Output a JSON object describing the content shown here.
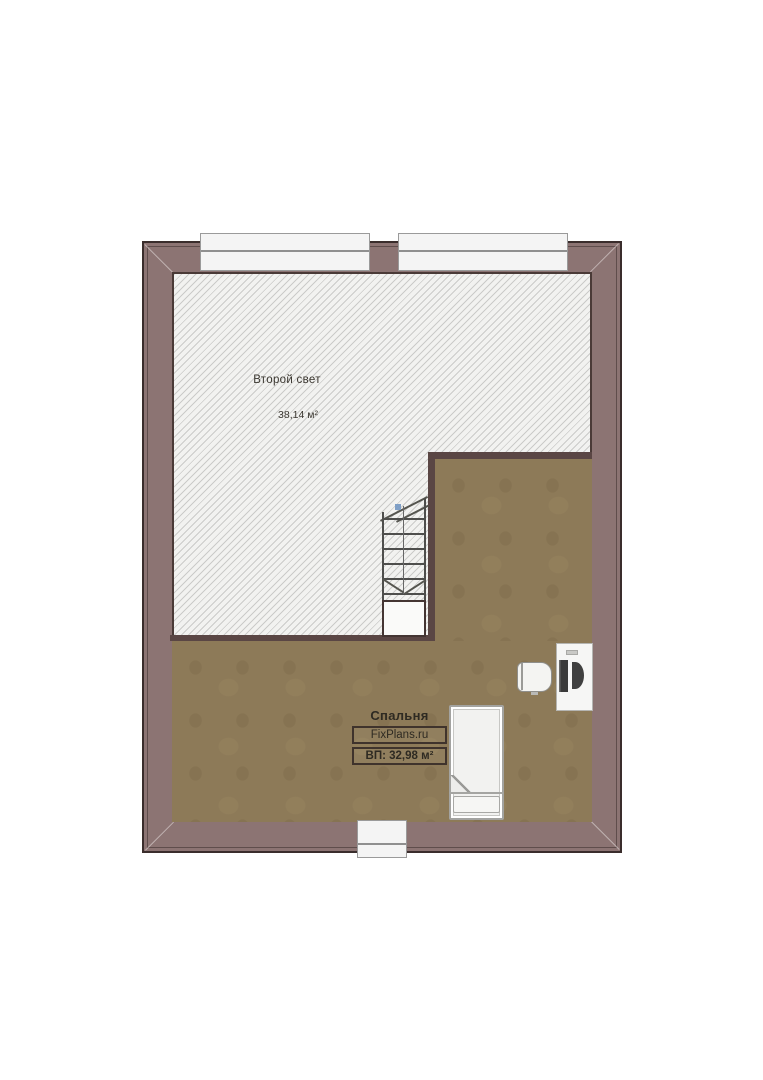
{
  "plan": {
    "type": "floor-plan",
    "rooms": [
      {
        "name": "Второй свет",
        "area": "38,14 м²"
      },
      {
        "name": "Спальня",
        "watermark": "FixPlans.ru",
        "area": "ВП: 32,98 м²"
      }
    ],
    "colors": {
      "wall": "#8c7473",
      "wall_outline": "#3a2d2c",
      "inner_wall": "#5a4644",
      "floor": "#8d7a58",
      "hatch_background": "#f2f2f0",
      "hatch_line": "#cbcbc9",
      "window": "#f4f4f4",
      "stair_marker_blue": "#7f9fc6"
    },
    "windows": {
      "top": 2,
      "bottom": 1
    },
    "furniture": [
      {
        "name": "stairs"
      },
      {
        "name": "bed"
      },
      {
        "name": "desk"
      },
      {
        "name": "desk-chair"
      }
    ]
  }
}
